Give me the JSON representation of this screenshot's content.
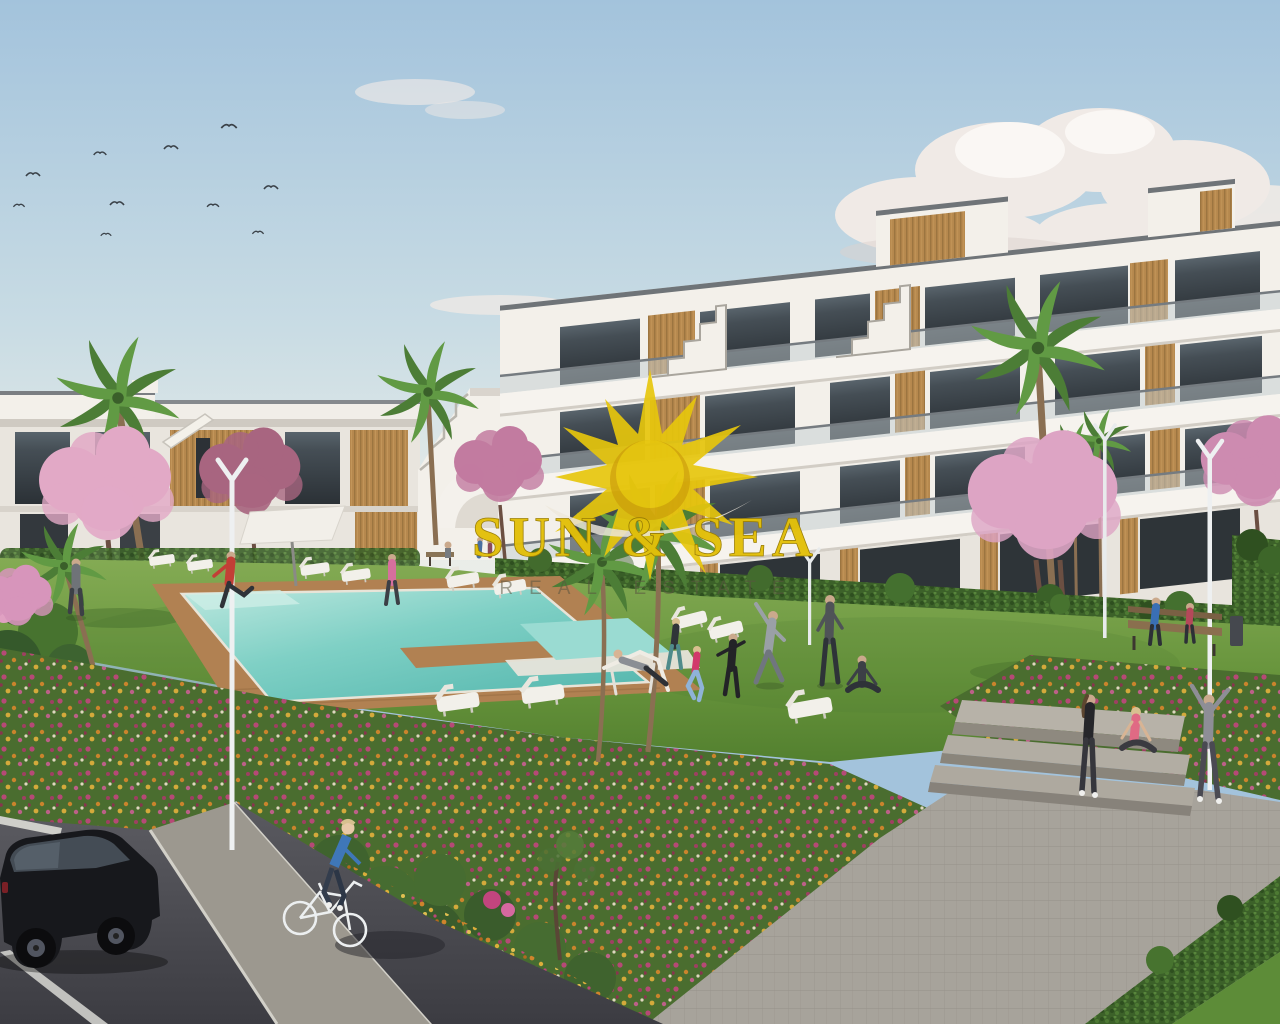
{
  "image": {
    "type": "architectural-render",
    "description": "3D render of a new-build apartment complex with communal swimming pool, lawns, flower beds and residents exercising; real-estate agency watermark in the centre",
    "width": 1280,
    "height": 1024
  },
  "watermark": {
    "logo": "sunburst-icon",
    "line1": "SUN & SEA",
    "line2": "REAL ESTATE",
    "gold": "#e3c00a",
    "subtitle_gray": "#5a5540"
  },
  "palette": {
    "sky_top": "#a3c3dc",
    "sky_horizon": "#e9ece8",
    "cloud_white": "#f0eae6",
    "building_white": "#f3f0ea",
    "building_shadow": "#d9d4cd",
    "glass_dark": "#333a40",
    "wood_accent": "#b6884e",
    "lawn_green": "#6d9a41",
    "lawn_dark": "#53802f",
    "hedge_green": "#3c6129",
    "pool_aqua": "#7fd0c5",
    "pool_deep": "#55b7ae",
    "deck_wood": "#b18152",
    "blossom_pink": "#dda4c4",
    "blossom_plum": "#a86580",
    "flower_magenta": "#c2457e",
    "flower_orange": "#d8862c",
    "flower_gold": "#e3b13c",
    "path_gray": "#a7a39b",
    "road_dark": "#46464c",
    "car_black": "#17181c"
  },
  "scene": {
    "sky": {
      "birds": 10,
      "clouds": "large cumulus upper right, thin wisps centre and left"
    },
    "buildings": [
      {
        "name": "apartment-block-left",
        "floors": 2,
        "style": "white modern terraced with wood slat accents"
      },
      {
        "name": "apartment-block-right",
        "floors": 4,
        "style": "white slab balconies, dark glazing, timber panels, roof stair gables"
      }
    ],
    "amenities": {
      "pool": "turquoise communal pool with timber deck and swim lane island",
      "sun_loungers": 11,
      "parasol": 1,
      "benches": 2,
      "street_lamps": 4,
      "steps": "wide paved steps on the right"
    },
    "vegetation": {
      "palm_trees": 8,
      "blossom_trees": 6,
      "flower_beds": "magenta / orange / gold flower bands along road and path",
      "hedges": "clipped hedges along building base and path corner"
    },
    "people": {
      "total": 18,
      "activities": [
        "cycling",
        "stretching",
        "yoga",
        "jogging",
        "sunbathing",
        "sitting on bench",
        "sitting on steps"
      ]
    },
    "vehicles": {
      "car": "black hatchback parked bottom left",
      "bicycle": "white city bike"
    }
  }
}
